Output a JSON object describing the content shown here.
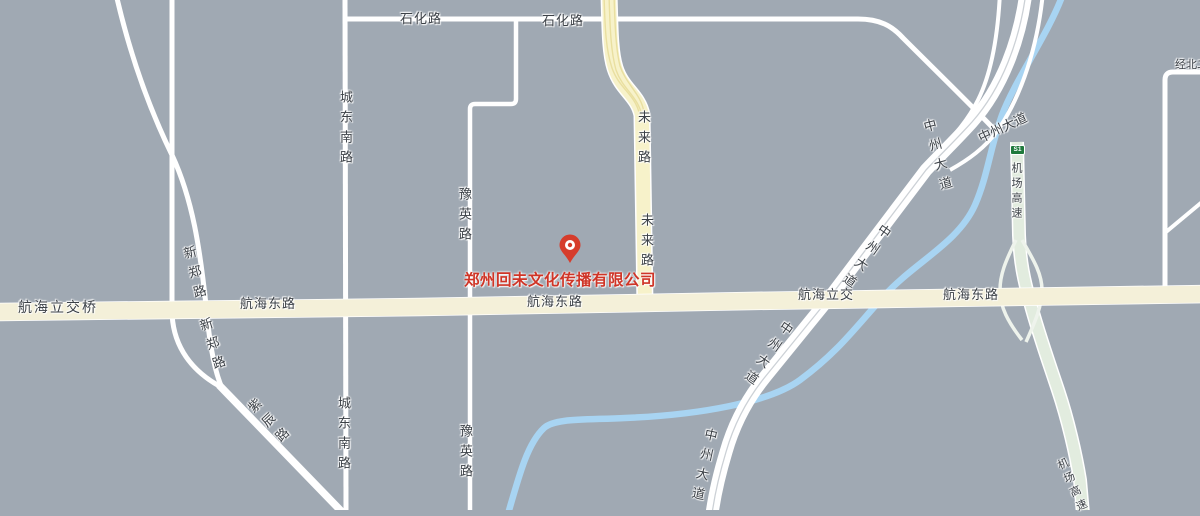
{
  "map": {
    "type": "street-map",
    "colors": {
      "background": "#a0a9b3",
      "road_white": "#ffffff",
      "road_major_yellow": "#f4f0d9",
      "road_minor_yellow": "#f7f2ca",
      "highway_green": "#e2ecdf",
      "river_blue": "#a8d4f2",
      "label_text": "#3c4147",
      "poi_red": "#cf3527",
      "shield_green": "#1f7a3c"
    },
    "labels": [
      {
        "id": "shihua-road-1",
        "text": "石化路"
      },
      {
        "id": "shihua-road-2",
        "text": "石化路"
      },
      {
        "id": "chengdongnan-road-top",
        "text": "城东南路"
      },
      {
        "id": "chengdongnan-road-btm",
        "text": "城东南路"
      },
      {
        "id": "yuying-road-top",
        "text": "豫英路"
      },
      {
        "id": "yuying-road-btm",
        "text": "豫英路"
      },
      {
        "id": "weilai-road-top",
        "text": "未来路"
      },
      {
        "id": "weilai-road-btm",
        "text": "未来路"
      },
      {
        "id": "xinzheng-road-top",
        "text": "新郑路"
      },
      {
        "id": "xinzheng-road-btm",
        "text": "新郑路"
      },
      {
        "id": "zichen-road",
        "text": "紫辰路"
      },
      {
        "id": "hanghai-lijiaoqiao",
        "text": "航海立交桥"
      },
      {
        "id": "hanghai-east-road-1",
        "text": "航海东路"
      },
      {
        "id": "hanghai-east-road-2",
        "text": "航海东路"
      },
      {
        "id": "hanghai-lijiao",
        "text": "航海立交"
      },
      {
        "id": "hanghai-east-road-3",
        "text": "航海东路"
      },
      {
        "id": "zhongzhou-ave-top",
        "text": "中州大道"
      },
      {
        "id": "zhongzhou-ave-merge",
        "text": "中州大道"
      },
      {
        "id": "zhongzhou-ave-upper",
        "text": "中州大道"
      },
      {
        "id": "zhongzhou-ave-lower",
        "text": "中州大道"
      },
      {
        "id": "zhongzhou-ave-bottom",
        "text": "中州大道"
      },
      {
        "id": "airport-expwy-top",
        "text": "机场高速"
      },
      {
        "id": "airport-expwy-btm",
        "text": "机场高速"
      },
      {
        "id": "jingbei-road",
        "text": "经北二路"
      }
    ],
    "poi": {
      "name": "郑州回未文化传播有限公司",
      "marker": "red-pin"
    },
    "shield": {
      "code": "S1"
    }
  }
}
